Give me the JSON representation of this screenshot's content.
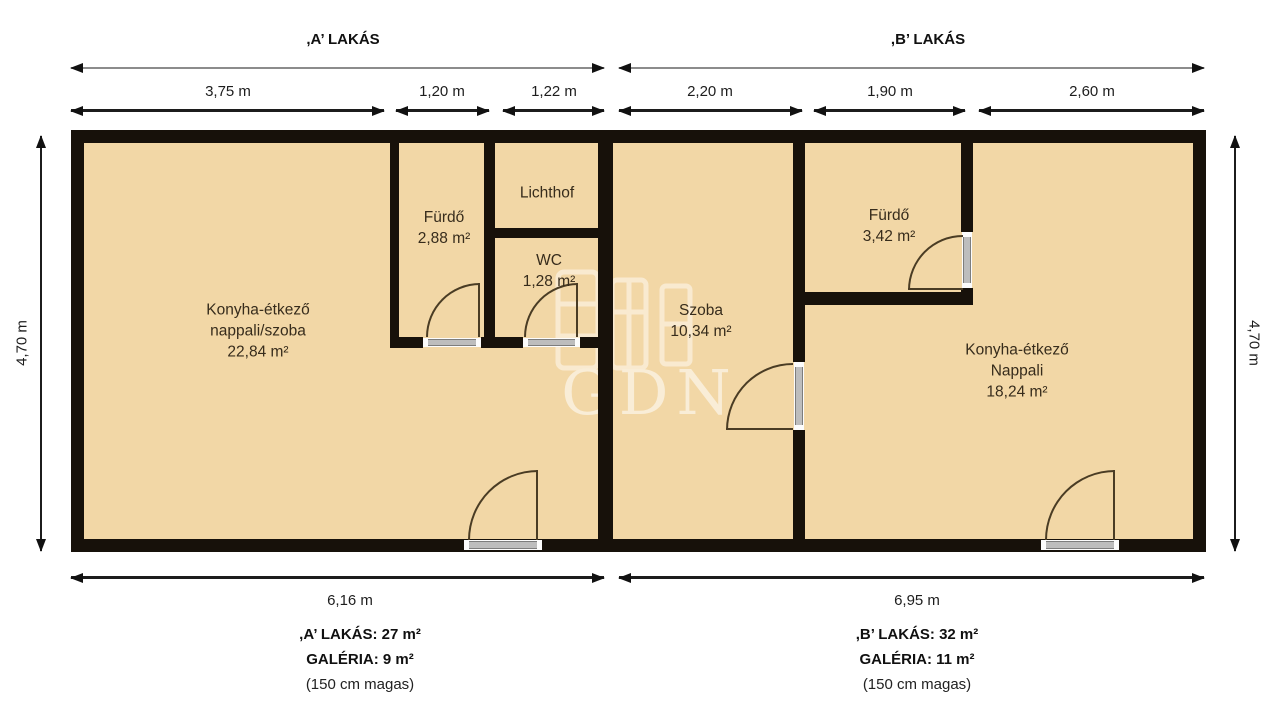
{
  "title_a": ",A’ LAKÁS",
  "title_b": ",B’ LAKÁS",
  "dims": {
    "a_segments": [
      "3,75 m",
      "1,20 m",
      "1,22 m"
    ],
    "b_segments": [
      "2,20 m",
      "1,90 m",
      "2,60 m"
    ],
    "a_width": "6,16 m",
    "b_width": "6,95 m",
    "left_height": "4,70 m",
    "right_height": "4,70 m"
  },
  "rooms": {
    "kitchen_a": {
      "line1": "Konyha-étkező",
      "line2": "nappali/szoba",
      "area": "22,84 m²"
    },
    "bath_a": {
      "line1": "Fürdő",
      "area": "2,88 m²"
    },
    "lichthof": {
      "line1": "Lichthof"
    },
    "wc": {
      "line1": "WC",
      "area": "1,28 m²"
    },
    "room_b": {
      "line1": "Szoba",
      "area": "10,34 m²"
    },
    "bath_b": {
      "line1": "Fürdő",
      "area": "3,42 m²"
    },
    "kitchen_b": {
      "line1": "Konyha-étkező",
      "line2": "Nappali",
      "area": "18,24 m²"
    }
  },
  "summary_a": {
    "line1": ",A’ LAKÁS: 27 m²",
    "line2": "GALÉRIA: 9 m²",
    "line3": "(150 cm magas)"
  },
  "summary_b": {
    "line1": ",B’ LAKÁS: 32 m²",
    "line2": "GALÉRIA: 11 m²",
    "line3": "(150 cm magas)"
  },
  "watermark": {
    "text": "GDN"
  },
  "colors": {
    "room_fill": "#F2D7A6",
    "wall": "#17110a",
    "door_arc": "#4a3c24"
  }
}
